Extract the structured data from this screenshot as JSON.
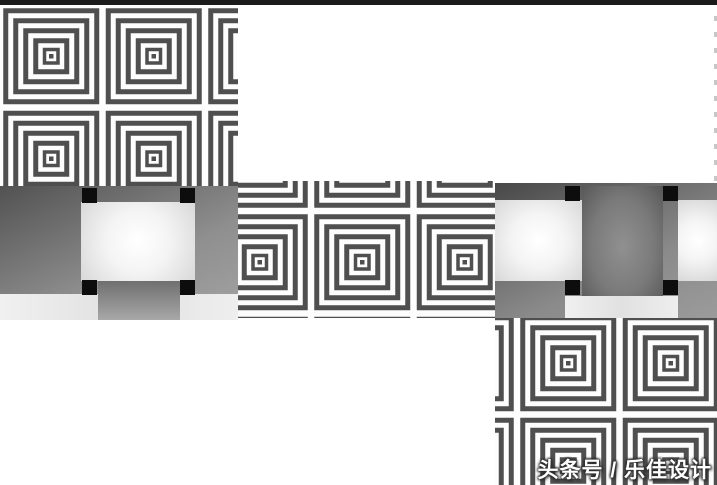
{
  "page": {
    "width": 717,
    "height": 485,
    "background": "#ffffff"
  },
  "top_bar": {
    "color": "#1b1b1b"
  },
  "watermark": {
    "text": "头条号 / 乐佳设计",
    "color": "#ffffff"
  },
  "patterns": {
    "stripes": {
      "dark": "#4f4f4f",
      "light": "#fdfdfd",
      "tile_size": 102.5
    },
    "weave": {
      "black": "#0d0d0d",
      "dark_gradient_start": "#4f4f4f",
      "dark_gradient_end": "#9c9c9c",
      "light_center": "#ffffff",
      "light_edge": "#d8d8d8",
      "strip_light": "#e8e8e8"
    }
  },
  "blocks": [
    {
      "name": "stripe-swatch-top-left"
    },
    {
      "name": "weave-swatch-left"
    },
    {
      "name": "stripe-swatch-center"
    },
    {
      "name": "weave-swatch-right"
    },
    {
      "name": "stripe-swatch-bottom-right"
    }
  ]
}
